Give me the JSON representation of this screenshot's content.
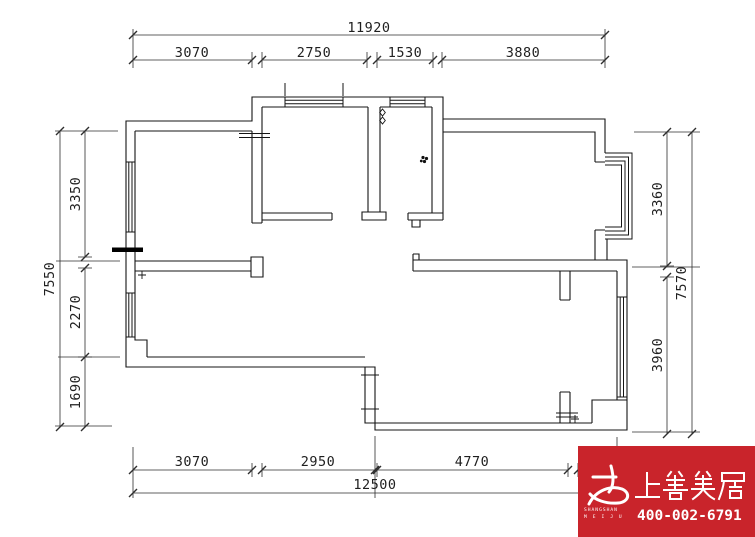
{
  "drawing": {
    "kind": "residential floor plan",
    "wall_color": "#141414",
    "dims": {
      "top": {
        "total": "11920",
        "seg": [
          "3070",
          "2750",
          "1530",
          "3880"
        ]
      },
      "bottom": {
        "total": "12500",
        "seg": [
          "3070",
          "2950",
          "4770"
        ]
      },
      "left": {
        "total": "7550",
        "seg": [
          "3350",
          "2270",
          "1690"
        ]
      },
      "right": {
        "total": "7570",
        "seg": [
          "3360",
          "3960"
        ]
      }
    }
  },
  "logo": {
    "name": "上善美居",
    "pinyin_line1": "SHANGSHAN",
    "pinyin_line2": "M E I J U",
    "phone": "400-002-6791",
    "color": "#c9242b"
  }
}
